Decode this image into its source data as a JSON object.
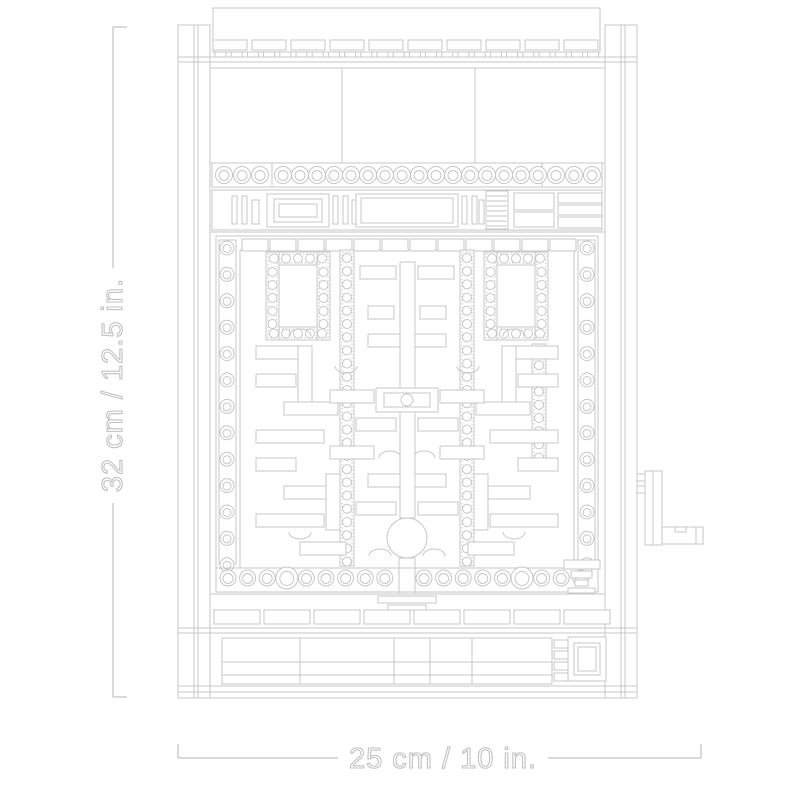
{
  "page": {
    "background_color": "#ffffff"
  },
  "diagram": {
    "subject": "lego-arcade-cabinet-line-drawing",
    "line_color": "#c7c7c7",
    "label_outline_color": "#c2c2c2"
  },
  "dimensions": {
    "height_label": "32 cm / 12.5 in.",
    "width_label": "25 cm / 10 in."
  }
}
